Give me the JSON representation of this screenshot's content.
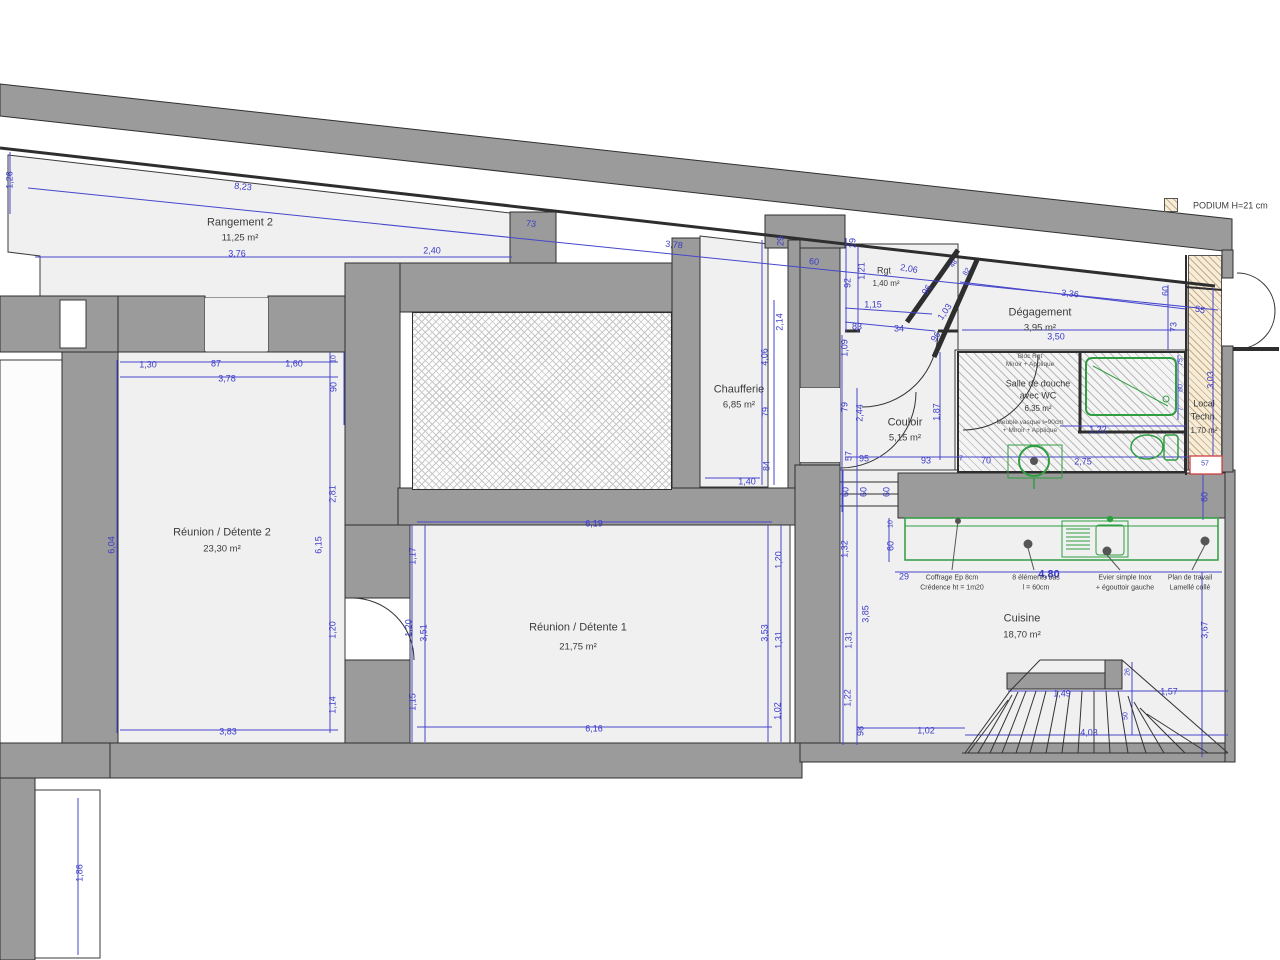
{
  "legend": {
    "podium_label": "PODIUM H=21 cm"
  },
  "rooms": [
    {
      "name": "Rangement 2",
      "area": "11,25 m²"
    },
    {
      "name": "Chaufferie",
      "area": "6,85 m²"
    },
    {
      "name": "Rgt",
      "area": "1,40 m²"
    },
    {
      "name": "Dégagement",
      "area": "3,95 m²"
    },
    {
      "line1": "Salle de douche",
      "line2": "avec WC",
      "area": "6,35 m²"
    },
    {
      "name": "Couloir",
      "area": "5,15 m²"
    },
    {
      "line1": "Local",
      "line2": "Techn.",
      "area": "1,70 m²"
    },
    {
      "name": "Réunion / Détente 2",
      "area": "23,30 m²"
    },
    {
      "name": "Réunion / Détente 1",
      "area": "21,75 m²"
    },
    {
      "name": "Cuisine",
      "area": "18,70 m²"
    }
  ],
  "annotations": {
    "bloc_rgt": [
      "Bloc Rgt",
      "Miroir + Applique"
    ],
    "vasque": [
      "Meuble vasque l=90cm",
      "+ Miroir + Applique"
    ],
    "kitchen": [
      [
        "Coffrage Ep 8cm",
        "Crédence ht = 1m20"
      ],
      [
        "8 éléments bas",
        "l = 60cm"
      ],
      [
        "Evier simple Inox",
        "+ égouttoir gauche"
      ],
      [
        "Plan de travail",
        "Lamellé collé"
      ]
    ]
  },
  "dims": [
    "1,26",
    "8,23",
    "73",
    "3,78",
    "3,76",
    "2,40",
    "29",
    "2,14",
    "60",
    "29",
    "1,21",
    "92",
    "2,06",
    "1,15",
    "83",
    "34",
    "96",
    "1,03",
    "96",
    "48",
    "82",
    "3,36",
    "3,50",
    "60",
    "55",
    "73",
    "3,03",
    "75",
    "80",
    "7",
    "1,22",
    "2,75",
    "70",
    "7",
    "93",
    "95",
    "57",
    "60",
    "60",
    "60",
    "60",
    "57",
    "1,09",
    "79",
    "2,44",
    "1,87",
    "4,06",
    "79",
    "84",
    "1,40",
    "1,30",
    "87",
    "1,60",
    "3,78",
    "6,04",
    "10",
    "90",
    "2,81",
    "6,15",
    "1,20",
    "1,14",
    "3,83",
    "6,19",
    "1,17",
    "1,20",
    "3,51",
    "1,15",
    "1,20",
    "3,53",
    "1,31",
    "1,02",
    "6,16",
    "10",
    "60",
    "29",
    "4,80",
    "1,32",
    "3,85",
    "1,31",
    "1,22",
    "98",
    "1,02",
    "4,03",
    "1,49",
    "1,57",
    "26",
    "50",
    "3,67",
    "1,86"
  ],
  "colors": {
    "wall": "#9b9b9b",
    "floor": "#f0f0f1",
    "dimension": "#3b3bc8",
    "fixture": "#2f9e41",
    "podium_fill": "#f5ecd9",
    "podium_line": "#c9a97e",
    "detail_box": "#cc3333"
  }
}
